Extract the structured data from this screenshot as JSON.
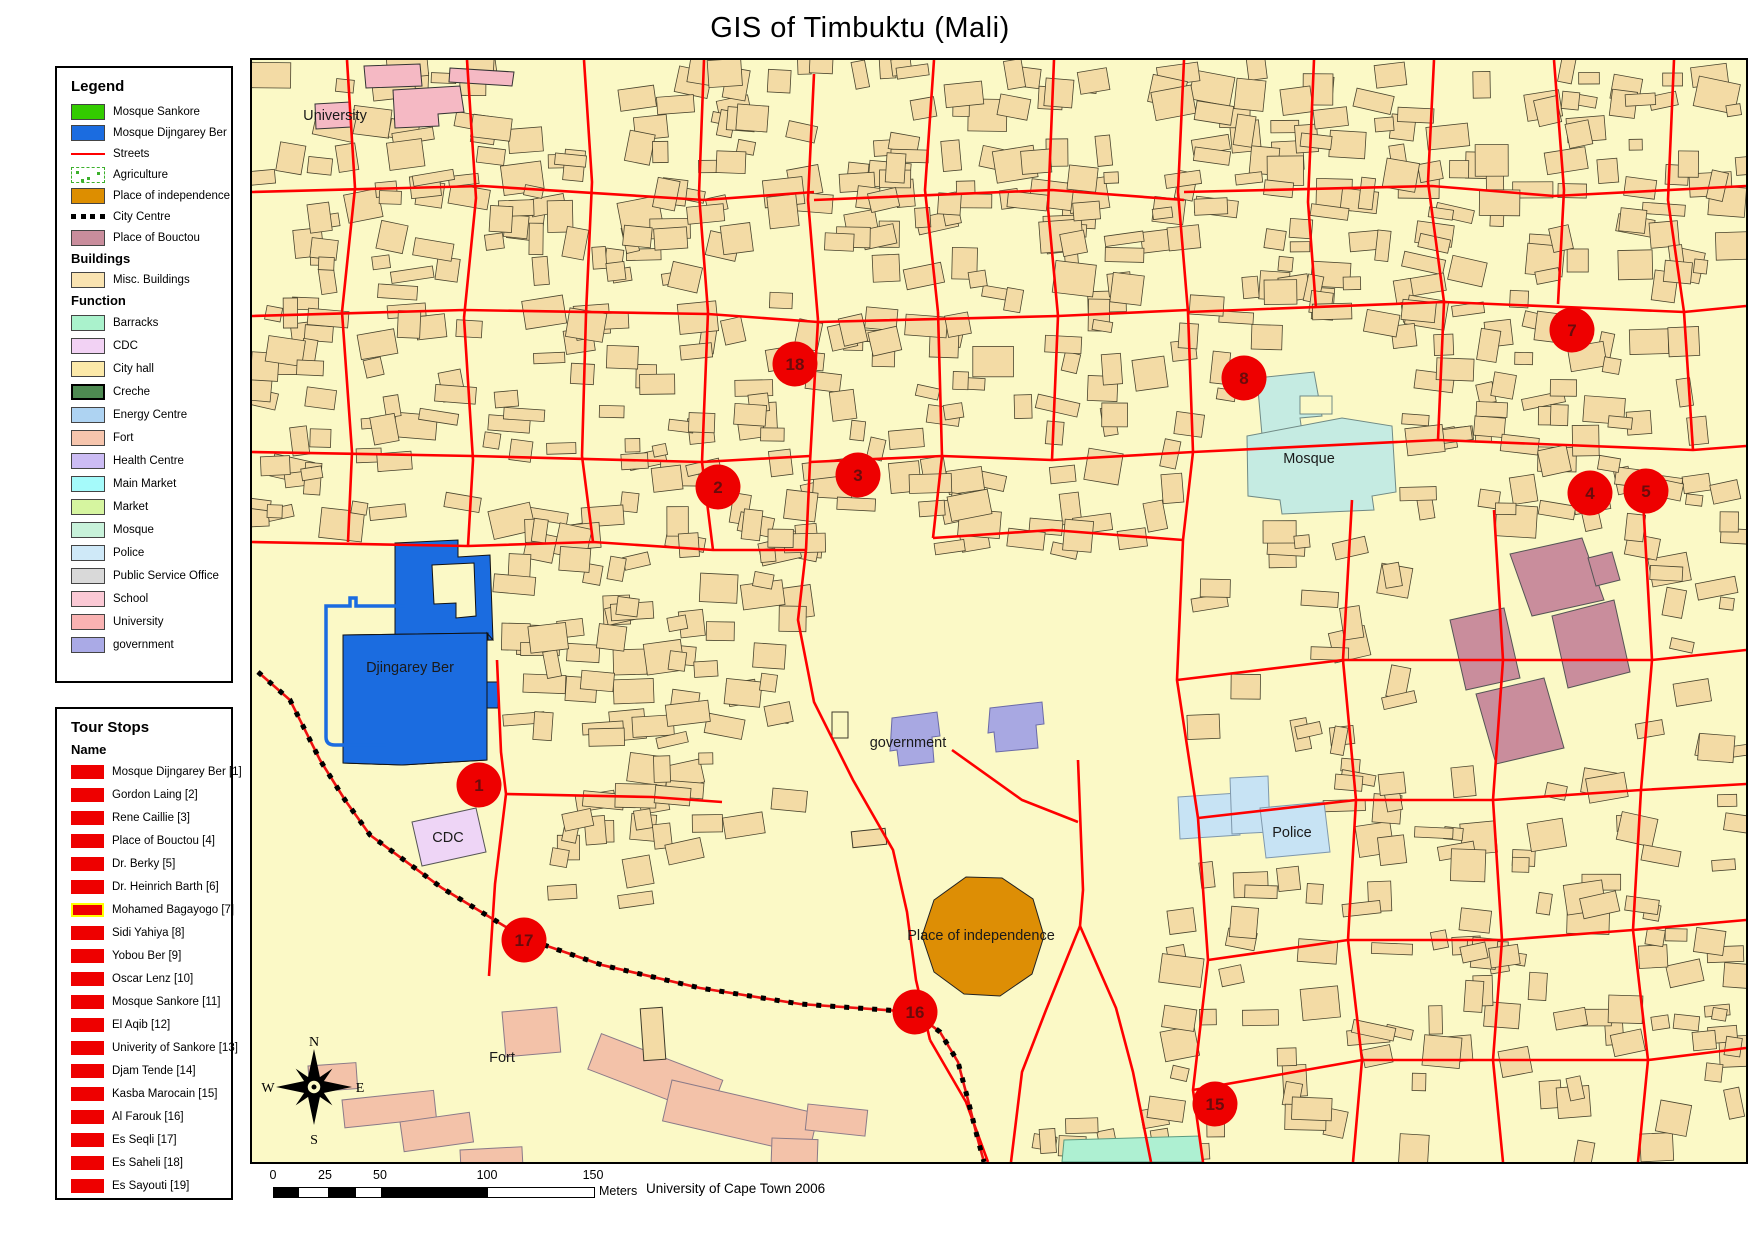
{
  "title": "GIS of Timbuktu (Mali)",
  "legend": {
    "header": "Legend",
    "items": [
      {
        "label": "Mosque Sankore",
        "type": "fill",
        "color": "#33cc00"
      },
      {
        "label": "Mosque Dijngarey Ber",
        "type": "fill",
        "color": "#1b6ce0"
      },
      {
        "label": "Streets",
        "type": "line",
        "color": "#ff0000"
      },
      {
        "label": "Agriculture",
        "type": "agriculture",
        "color": "#3cb02c"
      },
      {
        "label": "Place of independence",
        "type": "fill",
        "color": "#dd8e00"
      },
      {
        "label": "City Centre",
        "type": "dashes",
        "color": "#000000"
      },
      {
        "label": "Place of Bouctou",
        "type": "fill",
        "color": "#c98d9c"
      }
    ],
    "buildings_header": "Buildings",
    "buildings_items": [
      {
        "label": "Misc. Buildings",
        "type": "fill",
        "color": "#f9e3b1"
      }
    ],
    "function_header": "Function",
    "function_items": [
      {
        "label": "Barracks",
        "color": "#aaf2cc"
      },
      {
        "label": "CDC",
        "color": "#f2d2f4"
      },
      {
        "label": "City hall",
        "color": "#fce9a9"
      },
      {
        "label": "Creche",
        "color": "#4e8a52",
        "thick": true
      },
      {
        "label": "Energy Centre",
        "color": "#aed3f2"
      },
      {
        "label": "Fort",
        "color": "#f6c5ad"
      },
      {
        "label": "Health Centre",
        "color": "#ccbcf4"
      },
      {
        "label": "Main Market",
        "color": "#a5fafa"
      },
      {
        "label": "Market",
        "color": "#d6f5a0"
      },
      {
        "label": "Mosque",
        "color": "#c8f2da"
      },
      {
        "label": "Police",
        "color": "#cfe9f8"
      },
      {
        "label": "Public Service Office",
        "color": "#d9d9d9"
      },
      {
        "label": "School",
        "color": "#fbc9d5"
      },
      {
        "label": "University",
        "color": "#f9b2b2"
      },
      {
        "label": "government",
        "color": "#aaaae6"
      }
    ]
  },
  "tour_stops": {
    "header": "Tour Stops",
    "name_header": "Name",
    "marker_color": "#ee0000",
    "items": [
      {
        "label": "Mosque Dijngarey Ber [1]"
      },
      {
        "label": "Gordon Laing [2]"
      },
      {
        "label": "Rene Caillie [3]"
      },
      {
        "label": "Place of Bouctou [4]"
      },
      {
        "label": "Dr. Berky [5]"
      },
      {
        "label": "Dr. Heinrich Barth [6]"
      },
      {
        "label": "Mohamed Bagayogo [7]",
        "highlighted": true
      },
      {
        "label": "Sidi Yahiya [8]"
      },
      {
        "label": "Yobou Ber [9]"
      },
      {
        "label": "Oscar Lenz [10]"
      },
      {
        "label": "Mosque Sankore [11]"
      },
      {
        "label": "El Aqib [12]"
      },
      {
        "label": "Univerity of Sankore [13]"
      },
      {
        "label": "Djam Tende [14]"
      },
      {
        "label": "Kasba Marocain [15]"
      },
      {
        "label": "Al Farouk [16]"
      },
      {
        "label": "Es Seqli [17]"
      },
      {
        "label": "Es Saheli [18]"
      },
      {
        "label": "Es Sayouti [19]"
      }
    ]
  },
  "map": {
    "labels": [
      {
        "text": "University",
        "x": 83,
        "y": 60
      },
      {
        "text": "Djingarey Ber",
        "x": 158,
        "y": 612
      },
      {
        "text": "CDC",
        "x": 196,
        "y": 782
      },
      {
        "text": "government",
        "x": 656,
        "y": 687
      },
      {
        "text": "Mosque",
        "x": 1057,
        "y": 403
      },
      {
        "text": "Police",
        "x": 1040,
        "y": 777
      },
      {
        "text": "Place of independence",
        "x": 729,
        "y": 880
      },
      {
        "text": "Fort",
        "x": 250,
        "y": 1002
      }
    ],
    "tour_stop_markers": [
      {
        "number": "1",
        "x": 227,
        "y": 725
      },
      {
        "number": "2",
        "x": 466,
        "y": 427
      },
      {
        "number": "3",
        "x": 606,
        "y": 415
      },
      {
        "number": "4",
        "x": 1338,
        "y": 433
      },
      {
        "number": "5",
        "x": 1394,
        "y": 431
      },
      {
        "number": "7",
        "x": 1320,
        "y": 270
      },
      {
        "number": "8",
        "x": 992,
        "y": 318
      },
      {
        "number": "15",
        "x": 963,
        "y": 1044
      },
      {
        "number": "16",
        "x": 663,
        "y": 952
      },
      {
        "number": "17",
        "x": 272,
        "y": 880
      },
      {
        "number": "18",
        "x": 543,
        "y": 304
      }
    ],
    "compass": {
      "north": "N",
      "east": "E",
      "south": "S",
      "west": "W"
    }
  },
  "scale_bar": {
    "ticks": [
      "0",
      "25",
      "50",
      "100",
      "150"
    ],
    "unit": "Meters"
  },
  "attribution": "University of Cape Town 2006",
  "colors": {
    "map_background": "#fbf9c6",
    "street": "#ff0000",
    "building_fill": "#f3dba5",
    "marker_fill": "#ee0000",
    "marker_text": "#6b0b0b"
  }
}
